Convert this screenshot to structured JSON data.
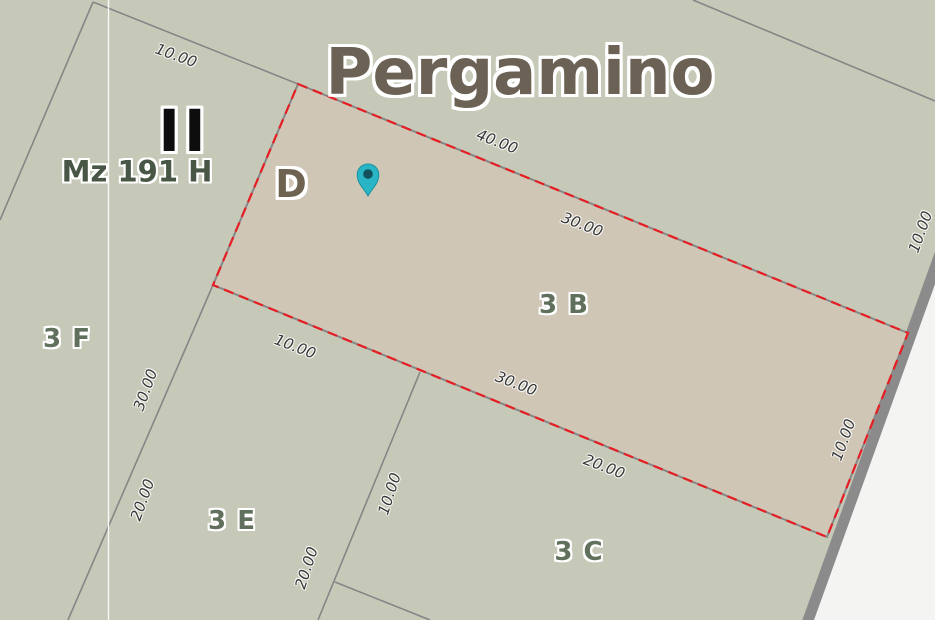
{
  "map": {
    "city_label": {
      "text": "Pergamino",
      "x": 520,
      "y": 73,
      "rot": 0
    },
    "block_label": {
      "text": "Mz 191 H",
      "x": 137,
      "y": 172,
      "rot": 0
    },
    "roman_numeral": {
      "text": "II",
      "x": 184,
      "y": 131,
      "rot": 0
    },
    "sub_parcel_label": {
      "text": "D",
      "x": 291,
      "y": 184,
      "rot": 0
    },
    "parcel_labels": [
      {
        "text": "3 B",
        "x": 564,
        "y": 305,
        "rot": 0
      },
      {
        "text": "3 F",
        "x": 67,
        "y": 339,
        "rot": 0
      },
      {
        "text": "3 E",
        "x": 232,
        "y": 521,
        "rot": 0
      },
      {
        "text": "3 C",
        "x": 579,
        "y": 552,
        "rot": 0
      }
    ],
    "dimension_labels": [
      {
        "text": "10.00",
        "x": 176,
        "y": 56,
        "rot": 20
      },
      {
        "text": "40.00",
        "x": 497,
        "y": 142,
        "rot": 21
      },
      {
        "text": "30.00",
        "x": 582,
        "y": 225,
        "rot": 21
      },
      {
        "text": "10.00",
        "x": 921,
        "y": 232,
        "rot": -70
      },
      {
        "text": "10.00",
        "x": 295,
        "y": 347,
        "rot": 21
      },
      {
        "text": "30.00",
        "x": 516,
        "y": 384,
        "rot": 21
      },
      {
        "text": "20.00",
        "x": 604,
        "y": 467,
        "rot": 21
      },
      {
        "text": "10.00",
        "x": 844,
        "y": 440,
        "rot": -70
      },
      {
        "text": "30.00",
        "x": 146,
        "y": 390,
        "rot": -70
      },
      {
        "text": "20.00",
        "x": 143,
        "y": 500,
        "rot": -70
      },
      {
        "text": "10.00",
        "x": 390,
        "y": 494,
        "rot": -72
      },
      {
        "text": "20.00",
        "x": 307,
        "y": 568,
        "rot": -72
      }
    ],
    "pin": {
      "x": 368,
      "y": 180
    },
    "colors": {
      "background": "#c6c9b8",
      "parcel_fill": "#cfc6b6",
      "outside": "#f4f4f3",
      "boundary_line": "#868686",
      "road_edge": "#8b8b8b",
      "selection_red": "#e61e23",
      "seam_white": "#ffffff",
      "title_text": "#6b6255",
      "block_text": "#485646",
      "roman_text": "#0d0d0d",
      "sub_parcel_text": "#6e6250",
      "parcel_text": "#61705c",
      "dimension_text": "#373737",
      "pin_fill": "#29b5c6",
      "pin_rim": "#1b93a3",
      "pin_dot": "#11525c"
    }
  }
}
